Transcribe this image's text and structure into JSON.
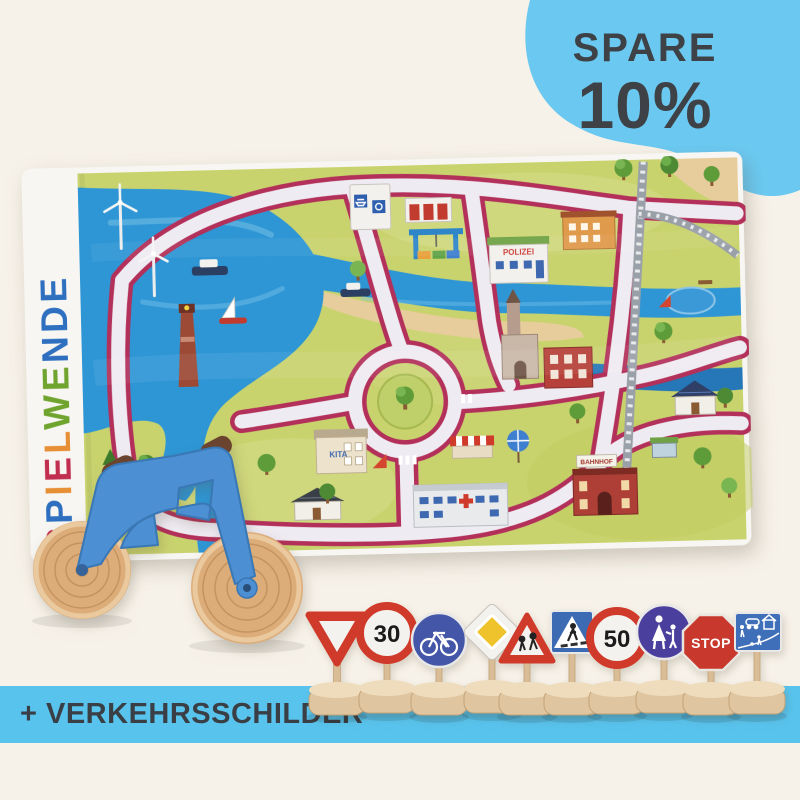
{
  "badge": {
    "line1": "SPARE",
    "line2": "10%",
    "background": "#6BC9F1",
    "text_color": "#3E4247"
  },
  "banner": {
    "text": "+ VERKEHRSSCHILDER",
    "background": "#58C4EE",
    "text_color": "#3A3F45"
  },
  "brand": {
    "name": "SPIELWENDE",
    "letters": [
      {
        "char": "S",
        "color": "#C22E50"
      },
      {
        "char": "P",
        "color": "#2E6FC0"
      },
      {
        "char": "I",
        "color": "#E78F35"
      },
      {
        "char": "E",
        "color": "#C22E50"
      },
      {
        "char": "L",
        "color": "#E78F35"
      },
      {
        "char": "W",
        "color": "#6FA42E"
      },
      {
        "char": "E",
        "color": "#6FA42E"
      },
      {
        "char": "N",
        "color": "#2E6FC0"
      },
      {
        "char": "D",
        "color": "#2E6FC0"
      },
      {
        "char": "E",
        "color": "#2E6FC0"
      }
    ]
  },
  "mat": {
    "labels": {
      "station": "BAHNHOF",
      "police": "POLIZEI",
      "kindergarten": "KITA"
    },
    "colors": {
      "land": "#C9D36E",
      "water": "#2E96D5",
      "road": "#EFEBF2",
      "road_edge": "#B23059",
      "sand": "#E7CD9C",
      "towel_border": "#F7F6F2"
    },
    "features": [
      "harbor",
      "ferry-terminal",
      "crane",
      "police-station",
      "church",
      "market-square",
      "roundabout",
      "railway",
      "train-station",
      "hospital",
      "kindergarten",
      "lighthouse",
      "wind-turbines",
      "pond",
      "playground",
      "beach",
      "boats",
      "trees"
    ]
  },
  "bike": {
    "frame_color": "#4C8FD2",
    "wheel_color": "#DCAC79"
  },
  "signs": {
    "wood_color": "#DFC6A0",
    "items": [
      {
        "name": "give-way",
        "shape": "triangle-down"
      },
      {
        "name": "speed-limit-30",
        "label": "30"
      },
      {
        "name": "bicycle-path",
        "shape": "blue-circle"
      },
      {
        "name": "priority-road",
        "shape": "yellow-diamond"
      },
      {
        "name": "children-crossing",
        "shape": "warning-triangle"
      },
      {
        "name": "pedestrian-crossing",
        "shape": "blue-square"
      },
      {
        "name": "speed-limit-50",
        "label": "50"
      },
      {
        "name": "pedestrian-path",
        "shape": "blue-circle"
      },
      {
        "name": "stop",
        "label": "STOP"
      },
      {
        "name": "play-street",
        "shape": "blue-rect"
      }
    ]
  }
}
